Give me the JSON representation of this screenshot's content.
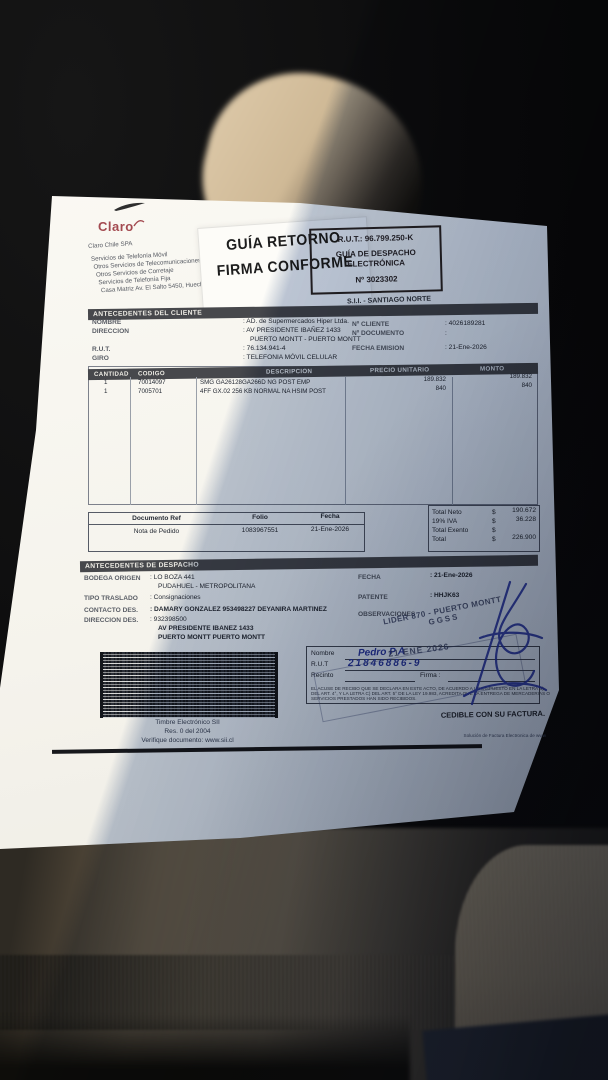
{
  "colors": {
    "paper": "#faf8f2",
    "shade_blue": "#6e84aa",
    "section_bar": "#47484c",
    "ink": "#262b35",
    "pen_blue": "#2a3a9c",
    "logo_red": "#a34a50",
    "seat_beige": "#d6c2a2",
    "garment_brown": "#6b5e4c"
  },
  "brand": {
    "logo_text": "Claro",
    "company_name": "Claro Chile SPA",
    "service_lines": [
      "Servicios de Telefonía Móvil",
      "Otros Servicios de Telecomunicaciones",
      "Otros Servicios de Corretaje",
      "Servicios de Telefonía Fija",
      "Casa Matriz Av. El Salto 5450, Huechuraba, S"
    ]
  },
  "return_stamp": {
    "line1": "GUÍA RETORNO",
    "line2": "FIRMA CONFORME"
  },
  "rut_box": {
    "rut": "R.U.T.: 96.799.250-K",
    "type_line1": "GUÍA DE DESPACHO",
    "type_line2": "ELECTRÓNICA",
    "number": "Nº 3023302"
  },
  "sii_office": "S.I.I. - SANTIAGO NORTE",
  "client": {
    "section_title": "ANTECEDENTES DEL CLIENTE",
    "labels": {
      "nombre": "NOMBRE",
      "direccion": "DIRECCION",
      "rut": "R.U.T.",
      "giro": "GIRO",
      "n_cliente": "Nº CLIENTE",
      "n_documento": "Nº DOCUMENTO",
      "fecha_emision": "FECHA EMISION"
    },
    "values": {
      "nombre": ":  AD. de Supermercados Hiper Ltda.",
      "direccion1": ":  AV PRESIDENTE IBAÑEZ 1433",
      "direccion2": "PUERTO MONTT -  PUERTO MONTT",
      "rut": ":  76.134.941-4",
      "giro": ":  TELEFONIA MÓVIL CELULAR",
      "n_cliente": ":  4026189281",
      "n_documento": ":",
      "fecha_emision": ":  21-Ene-2026"
    }
  },
  "items": {
    "headers": [
      "CANTIDAD",
      "CODIGO",
      "DESCRIPCION",
      "PRECIO UNITARIO",
      "MONTO"
    ],
    "rows": [
      {
        "cantidad": "1",
        "codigo": "70014097",
        "descripcion": "SMG GA26128GA266D NG POST EMP",
        "precio_unitario": "189.832",
        "monto": "189.832"
      },
      {
        "cantidad": "1",
        "codigo": "7005701",
        "descripcion": "4FF GX.02 256 KB NORMAL NA HSIM POST",
        "precio_unitario": "840",
        "monto": "840"
      }
    ]
  },
  "doc_ref": {
    "headers": [
      "Documento Ref",
      "Folio",
      "Fecha"
    ],
    "row": {
      "documento": "Nota de Pedido",
      "folio": "1083967551",
      "fecha": "21-Ene-2026"
    }
  },
  "totals": {
    "rows": [
      {
        "label": "Total Neto",
        "currency": "$",
        "value": "190.672"
      },
      {
        "label": "19% IVA",
        "currency": "$",
        "value": "36.228"
      },
      {
        "label": "Total Exento",
        "currency": "$",
        "value": ""
      },
      {
        "label": "Total",
        "currency": "$",
        "value": "226.900"
      }
    ]
  },
  "dispatch": {
    "section_title": "ANTECEDENTES DE DESPACHO",
    "labels": {
      "bodega": "BODEGA ORIGEN",
      "tipo": "TIPO TRASLADO",
      "contacto": "CONTACTO DES.",
      "direccion": "DIRECCION DES.",
      "fecha": "FECHA",
      "patente": "PATENTE",
      "observaciones": "OBSERVACIONES"
    },
    "values": {
      "bodega1": ":  LO BOZA 441",
      "bodega2": "PUDAHUEL - METROPOLITANA",
      "tipo": ":  Consignaciones",
      "contacto": ":  DAMARY GONZALEZ 953498227 DEYANIRA MARTINEZ",
      "direccion1": ":  932398500",
      "direccion2": "AV PRESIDENTE IBANEZ 1433",
      "direccion3": "PUERTO MONTT   PUERTO MONTT",
      "fecha": ":  21-Ene-2026",
      "patente": ":  HHJK63"
    }
  },
  "timbre": {
    "line1": "Timbre Electrónico SII",
    "line2": "Res. 0 del 2004",
    "line3": "Verifique documento: www.sii.cl"
  },
  "signature_box": {
    "labels": {
      "nombre": "Nombre",
      "rut": "R.U.T",
      "recinto": "Recinto",
      "firma": "Firma :"
    },
    "handwritten": {
      "nombre": "Pedro  P A",
      "rut": "21846886-9"
    },
    "legal_lines": [
      "EL ACUSE DE RECIBO QUE SE DECLARA EN ESTE ACTO, DE ACUERDO A LO DISPUESTO EN LA LETRA B)",
      "DEL ART. 4°, Y LA LETRA C) DEL ART. 5° DE LA LEY 19.983, ACREDITA QUE LA ENTREGA DE MERCADERIAS O",
      "SERVICIOS PRESTADOS HAN SIDO RECIBIDOS."
    ],
    "cedible": "CEDIBLE CON SU FACTURA."
  },
  "stamps": {
    "lider_line1": "LIDER 870 - PUERTO MONTT",
    "lider_line2": "GGSS",
    "date": "21 ENE 2026"
  },
  "footer": {
    "provider": "Solución de Factura Electronica de www"
  }
}
